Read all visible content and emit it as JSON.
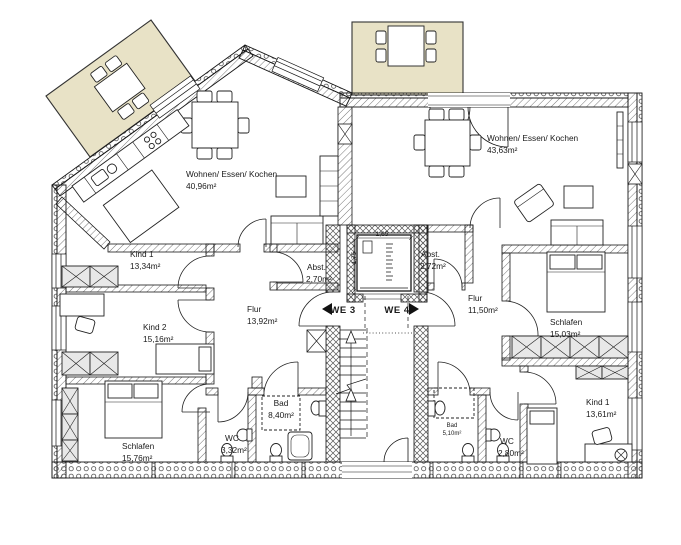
{
  "plan": {
    "colors": {
      "balcony_fill": "#e8e2c6",
      "wall_line": "#161616",
      "hatch_line": "#555555",
      "wardrobe_fill": "#e8e8e8",
      "text": "#1a1a1a"
    },
    "apartments": [
      {
        "id": "WE3",
        "label": "WE 3",
        "rooms": [
          {
            "name": "Wohnen/ Essen/ Kochen",
            "area": "40,96m²"
          },
          {
            "name": "Kind 1",
            "area": "13,34m²"
          },
          {
            "name": "Kind 2",
            "area": "15,16m²"
          },
          {
            "name": "Schlafen",
            "area": "15,76m²"
          },
          {
            "name": "WC",
            "area": "3,32m²"
          },
          {
            "name": "Bad",
            "area": "8,40m²"
          },
          {
            "name": "Abst.",
            "area": "2,70m²"
          },
          {
            "name": "Flur",
            "area": "13,92m²"
          }
        ]
      },
      {
        "id": "WE4",
        "label": "WE 4",
        "rooms": [
          {
            "name": "Wohnen/ Essen/ Kochen",
            "area": "43,63m²"
          },
          {
            "name": "Abst.",
            "area": "2,72m²"
          },
          {
            "name": "Flur",
            "area": "11,50m²"
          },
          {
            "name": "Schlafen",
            "area": "15,03m²"
          },
          {
            "name": "Kind 1",
            "area": "13,61m²"
          },
          {
            "name": "Bad",
            "area": "5,10m²"
          },
          {
            "name": "WC",
            "area": "2,80m²"
          }
        ]
      }
    ],
    "elevator": {
      "width_label": "1,65",
      "depth_label": "1,75"
    }
  }
}
